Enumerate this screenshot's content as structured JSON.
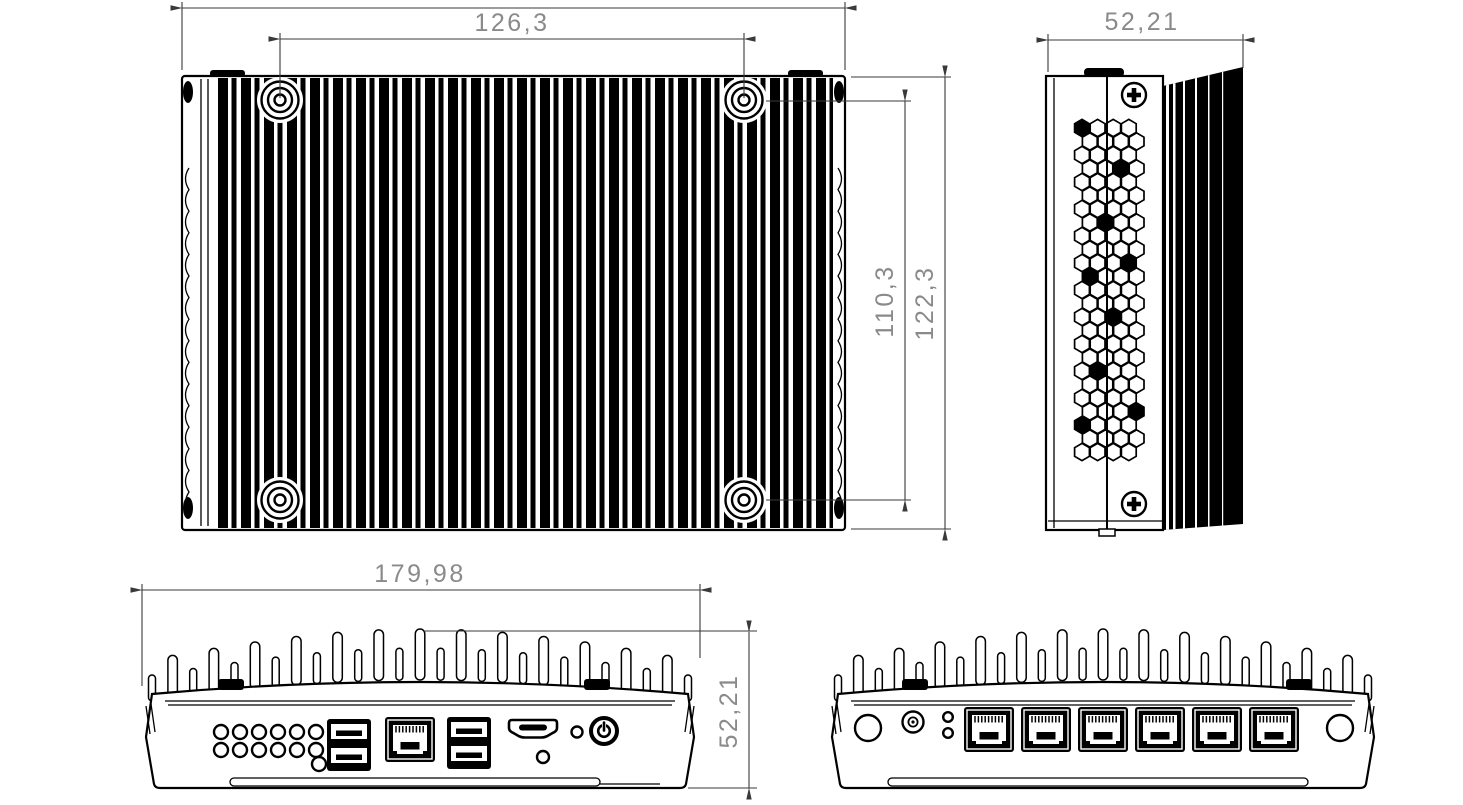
{
  "drawing": {
    "colors": {
      "background": "#ffffff",
      "lines": "#000000",
      "dimension_lines": "#3a3a3a",
      "dimension_text": "#8a8a8a"
    },
    "views": {
      "top": {
        "width_between_screws": "126,3",
        "height_between_screws": "110,3",
        "height_overall": "122,3"
      },
      "side": {
        "depth_overall": "52,21"
      },
      "front": {
        "width_overall": "179,98",
        "height_overall": "52,21"
      }
    }
  }
}
